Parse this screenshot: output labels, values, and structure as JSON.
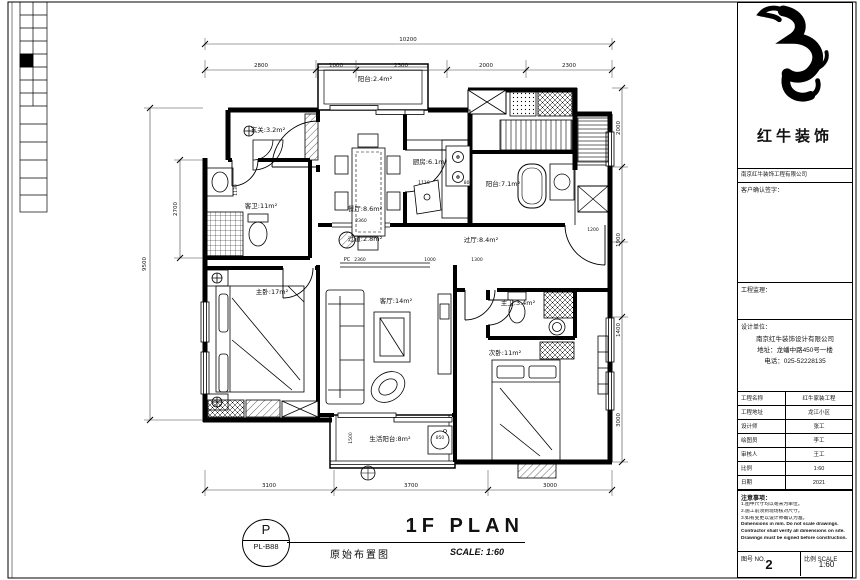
{
  "footer": {
    "stamp_letter": "P",
    "stamp_code": "PL-B88",
    "title": "1F PLAN",
    "subtitle": "原始布置图",
    "scale": "SCALE: 1:60"
  },
  "title_block": {
    "brand": "红牛装饰",
    "brand_sub": "南京红牛装饰工程有限公司",
    "sign_label": "客户确认签字：",
    "supervisor_label": "工程监理：",
    "design_label": "设计单位：",
    "company_lines": [
      "南京红牛装饰设计有限公司",
      "地址：龙蟠中路450号一楼",
      "电话：025-52228135"
    ],
    "rows": [
      {
        "label": "工程名称",
        "value": "红牛家装工程"
      },
      {
        "label": "工程地址",
        "value": "龙江小区"
      },
      {
        "label": "设计师",
        "value": "张工"
      },
      {
        "label": "绘图员",
        "value": "李工"
      },
      {
        "label": "审核人",
        "value": "王工"
      },
      {
        "label": "比例",
        "value": "1:60"
      },
      {
        "label": "日期",
        "value": "2021"
      }
    ],
    "notes_title": "注意事项：",
    "notes": [
      {
        "text": "1.图中尺寸均以毫米为单位。",
        "bold": false
      },
      {
        "text": "2.施工前须到现场核对尺寸。",
        "bold": false
      },
      {
        "text": "3.如有变更以设计师确认为准。",
        "bold": false
      },
      {
        "text": "Dimensions in mm. Do not scale drawings.",
        "bold": true
      },
      {
        "text": "Contractor shall verify all dimensions on site.",
        "bold": true
      },
      {
        "text": "Drawings must be signed before construction.",
        "bold": true
      }
    ],
    "no_label": "图号 NO.",
    "page_number": "2",
    "scale_label": "比例 SCALE",
    "scale_value": "1:60"
  },
  "plan": {
    "rooms": [
      {
        "t": "阳台:2.4m²",
        "x": 375,
        "y": 81
      },
      {
        "t": "玄关:3.2m²",
        "x": 268,
        "y": 132
      },
      {
        "t": "餐厅:8.6m²",
        "x": 365,
        "y": 211
      },
      {
        "t": "厨房:6.1m²",
        "x": 430,
        "y": 164
      },
      {
        "t": "阳台:7.1m²",
        "x": 503,
        "y": 186
      },
      {
        "t": "客卫:11m²",
        "x": 261,
        "y": 208
      },
      {
        "t": "过道:2.8m²",
        "x": 365,
        "y": 241
      },
      {
        "t": "过厅:8.4m²",
        "x": 481,
        "y": 242
      },
      {
        "t": "主卧:17m²",
        "x": 272,
        "y": 294
      },
      {
        "t": "客厅:14m²",
        "x": 396,
        "y": 303
      },
      {
        "t": "主卫:3.4m²",
        "x": 518,
        "y": 305
      },
      {
        "t": "次卧:11m²",
        "x": 505,
        "y": 355
      },
      {
        "t": "生活阳台:8m²",
        "x": 390,
        "y": 441
      }
    ],
    "dims": [
      {
        "t": "10200",
        "x": 408,
        "y": 41
      },
      {
        "t": "2800",
        "x": 261,
        "y": 67
      },
      {
        "t": "1000",
        "x": 336,
        "y": 67
      },
      {
        "t": "2300",
        "x": 401,
        "y": 67
      },
      {
        "t": "2000",
        "x": 486,
        "y": 67
      },
      {
        "t": "2300",
        "x": 569,
        "y": 67
      },
      {
        "t": "3100",
        "x": 269,
        "y": 487
      },
      {
        "t": "3700",
        "x": 411,
        "y": 487
      },
      {
        "t": "3000",
        "x": 550,
        "y": 487
      },
      {
        "t": "9500",
        "x": 146,
        "y": 264,
        "r": 1
      },
      {
        "t": "2700",
        "x": 177,
        "y": 209,
        "r": 1
      },
      {
        "t": "1130",
        "x": 237,
        "y": 190,
        "r": 1,
        "s": 4.5
      },
      {
        "t": "2000",
        "x": 620,
        "y": 128,
        "r": 1
      },
      {
        "t": "1900",
        "x": 620,
        "y": 240,
        "r": 1
      },
      {
        "t": "1400",
        "x": 620,
        "y": 330,
        "r": 1
      },
      {
        "t": "3000",
        "x": 620,
        "y": 420,
        "r": 1
      },
      {
        "t": "2360",
        "x": 361,
        "y": 222,
        "s": 4.5
      },
      {
        "t": "2360",
        "x": 360,
        "y": 261,
        "s": 4.5
      },
      {
        "t": "1000",
        "x": 430,
        "y": 261,
        "s": 4.5
      },
      {
        "t": "1300",
        "x": 477,
        "y": 261,
        "s": 4.5
      },
      {
        "t": "1110",
        "x": 424,
        "y": 184,
        "s": 4.5
      },
      {
        "t": "800",
        "x": 468,
        "y": 184,
        "s": 4.5
      },
      {
        "t": "1200",
        "x": 593,
        "y": 231,
        "s": 4.5
      },
      {
        "t": "850",
        "x": 440,
        "y": 439,
        "s": 4.5
      },
      {
        "t": "1500",
        "x": 352,
        "y": 438,
        "r": 1,
        "s": 4.5
      },
      {
        "t": "PC",
        "x": 347,
        "y": 261,
        "s": 5
      }
    ]
  }
}
